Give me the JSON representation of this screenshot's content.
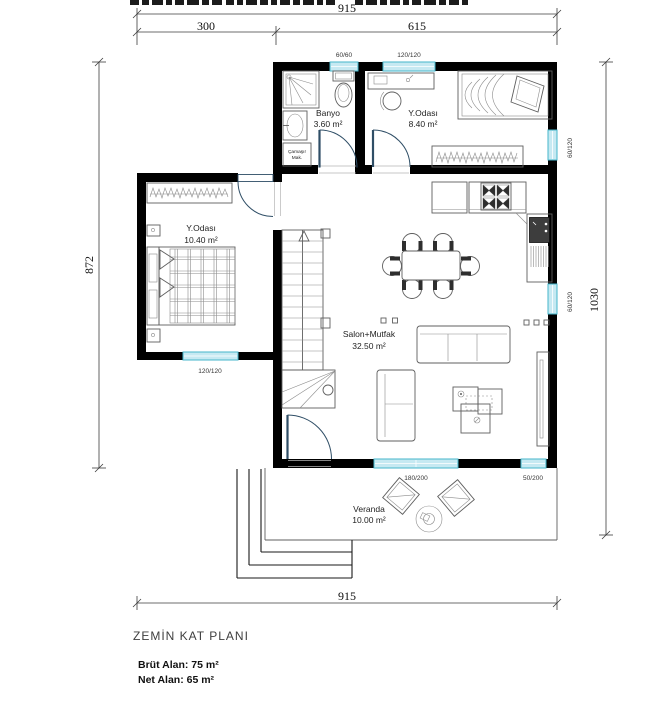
{
  "dimensions": {
    "top_total": "915",
    "top_segment_left": "300",
    "top_segment_right": "615",
    "left_height": "872",
    "right_height": "1030",
    "bottom_total": "915"
  },
  "windows": {
    "bath_top": "60/60",
    "bedroom_top": "120/120",
    "right_upper": "60/120",
    "right_lower": "60/120",
    "bedroom_left_bottom": "120/120",
    "salon_bottom_large": "180/200",
    "salon_bottom_small": "50/200"
  },
  "rooms": {
    "banyo": {
      "name": "Banyo",
      "area": "3.60 m²"
    },
    "bed_top": {
      "name": "Y.Odası",
      "area": "8.40 m²"
    },
    "bed_left": {
      "name": "Y.Odası",
      "area": "10.40 m²"
    },
    "salon": {
      "name": "Salon+Mutfak",
      "area": "32.50 m²"
    },
    "veranda": {
      "name": "Veranda",
      "area": "10.00 m²"
    }
  },
  "appliances": {
    "washer_line1": "Çamaşır",
    "washer_line2": "Mak."
  },
  "footer": {
    "plan_title": "ZEMİN KAT PLANI",
    "gross_area": "Brüt Alan: 75 m²",
    "net_area": "Net Alan: 65 m²"
  },
  "colors": {
    "wall": "#000000",
    "window_fill": "#c6e9f2",
    "window_stroke": "#45b6cb",
    "door_arc": "#2f4e66",
    "furniture_line": "#5f5f5f"
  }
}
